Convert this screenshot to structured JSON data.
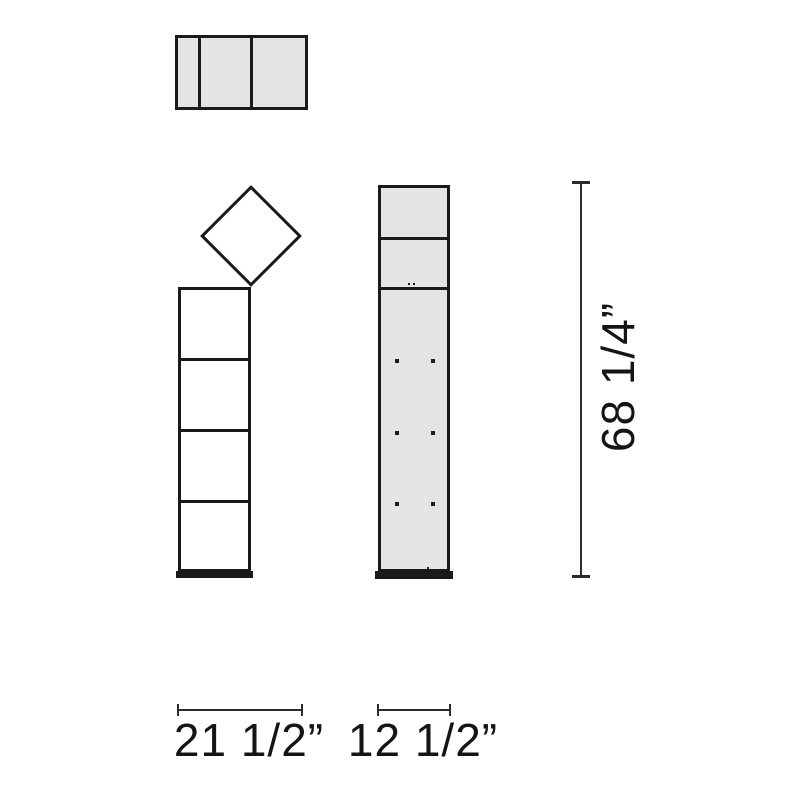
{
  "theme": {
    "background": "#ffffff",
    "outline": "#1a1a1a",
    "dimension_line": "#2b2b2b",
    "panel_gray": "#e4e4e4",
    "panel_white": "#ffffff",
    "text": "#151515"
  },
  "dimensions": {
    "front_width": "21 1/2”",
    "side_width": "12 1/2”",
    "height": "68 1/4”"
  }
}
